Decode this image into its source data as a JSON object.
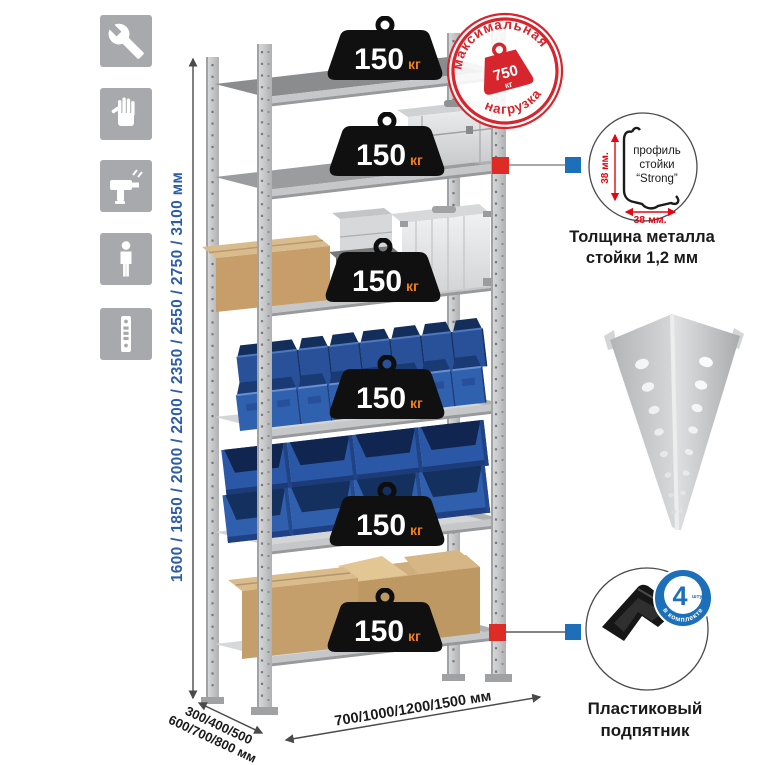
{
  "tools_panel": {
    "items": [
      {
        "icon": "wrench-icon"
      },
      {
        "icon": "gloves-icon"
      },
      {
        "icon": "drill-icon"
      },
      {
        "icon": "person-icon"
      },
      {
        "icon": "upright-profile-icon"
      }
    ]
  },
  "dimensions": {
    "height": "1600 / 1850 / 2000 / 2200 / 2350 / 2550 / 2750 / 3100 мм",
    "depth_line1": "300/400/500",
    "depth_line2": "600/700/800 мм",
    "width": "700/1000/1200/1500 мм"
  },
  "shelf_weight": {
    "value": "150",
    "unit": "кг"
  },
  "stamp": {
    "arc_top": "максимальная",
    "arc_bottom": "нагрузка",
    "value": "750",
    "unit": "кг"
  },
  "profile": {
    "text_line1": "профиль",
    "text_line2": "стойки",
    "text_line3": "“Strong”",
    "vertical_dim": "38 мм.",
    "horizontal_dim": "38 мм.",
    "caption1": "Толщина металла",
    "caption2": "стойки 1,2 мм"
  },
  "foot": {
    "badge_number": "4",
    "badge_unit": "штуки",
    "badge_arc": "в комплекте",
    "caption1": "Пластиковый",
    "caption2": "подпятник"
  },
  "colors": {
    "accent_red": "#d6252c",
    "accent_blue": "#1c6fb8",
    "dim_text_blue": "#2d5ca8",
    "weight_unit_orange": "#ef7f1a",
    "bin_blue": "#2f5fad",
    "steel": "#c9cacc",
    "cardboard": "#c2a06e",
    "icon_tile_gray": "#a7a9ac"
  }
}
